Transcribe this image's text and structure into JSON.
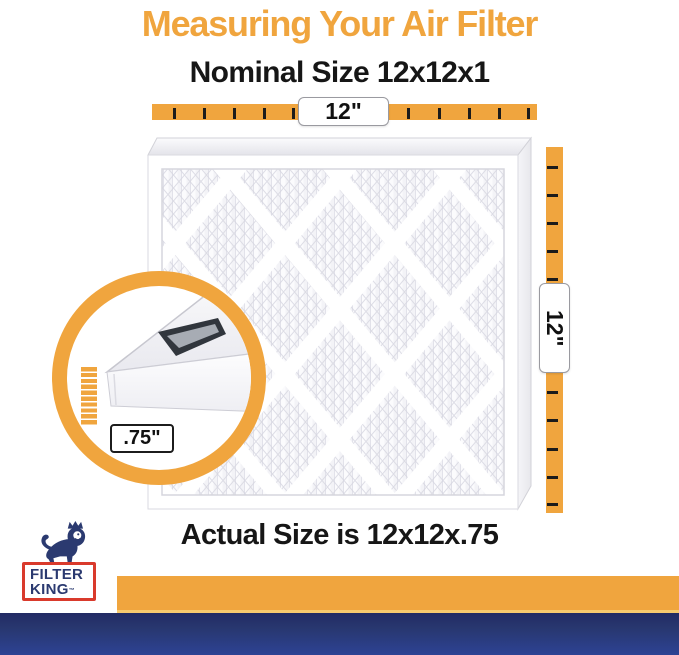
{
  "header": {
    "title": "Measuring Your Air Filter",
    "nominal_size": "Nominal Size 12x12x1"
  },
  "measurements": {
    "width_label": "12\"",
    "height_label": "12\"",
    "depth_label": ".75\""
  },
  "footer": {
    "actual_size": "Actual Size is 12x12x.75"
  },
  "logo": {
    "line1": "FILTER",
    "line2": "KING",
    "trademark": "™"
  },
  "icons": {
    "lion_crown_logo": "lion-with-crown",
    "magnifier": "depth-zoom-circle"
  },
  "colors": {
    "accent_orange": "#F0A53E",
    "brand_navy": "#2B3A70",
    "logo_red": "#D93A2C",
    "footer_blue_top": "#222B64",
    "footer_blue_bottom": "#2D4294"
  }
}
